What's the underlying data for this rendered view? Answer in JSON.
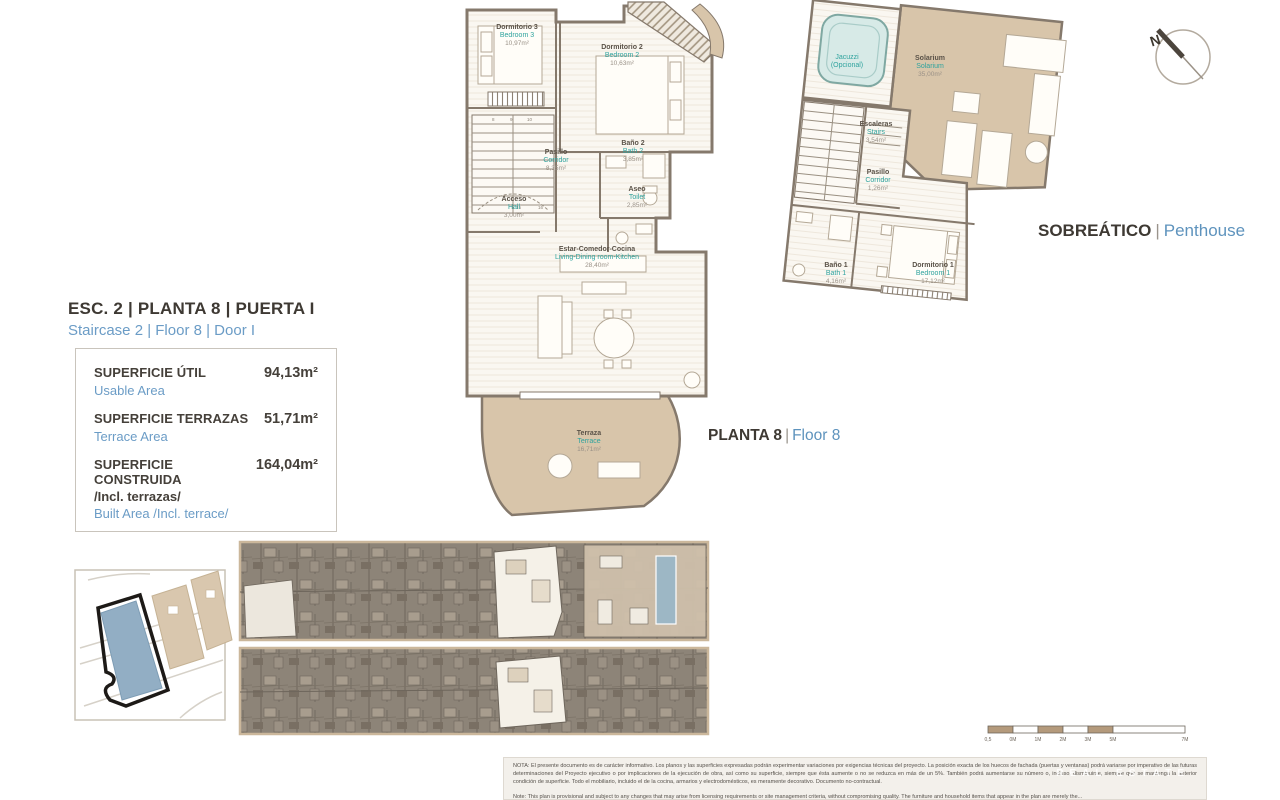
{
  "header": {
    "compass_label": "N",
    "penthouse_title": {
      "es": "SOBREÁTICO",
      "sep": "|",
      "en": "Penthouse"
    },
    "floor_title": {
      "es": "PLANTA 8",
      "sep": "|",
      "en": "Floor 8"
    }
  },
  "unit": {
    "title_es": "ESC. 2 | PLANTA 8 | PUERTA I",
    "title_en": "Staircase 2 | Floor 8 | Door I"
  },
  "areas": {
    "usable": {
      "label_es": "SUPERFICIE ÚTIL",
      "label_en": "Usable Area",
      "value": "94,13m²"
    },
    "terrace": {
      "label_es": "SUPERFICIE TERRAZAS",
      "label_en": "Terrace Area",
      "value": "51,71m²"
    },
    "built": {
      "label_es": "SUPERFICIE CONSTRUIDA",
      "label_es2": "/Incl. terrazas/",
      "label_en": "Built Area /Incl. terrace/",
      "value": "164,04m²"
    }
  },
  "floor8_rooms": [
    {
      "es": "Dormitorio 3",
      "en": "Bedroom 3",
      "area": "10,97m²"
    },
    {
      "es": "Dormitorio 2",
      "en": "Bedroom 2",
      "area": "10,63m²"
    },
    {
      "es": "Baño 2",
      "en": "Bath 2",
      "area": "3,85m²"
    },
    {
      "es": "Aseo",
      "en": "Toilet",
      "area": "2,85m²"
    },
    {
      "es": "Pasillo",
      "en": "Corridor",
      "area": "8,35m²"
    },
    {
      "es": "Acceso",
      "en": "Hall",
      "area": "3,00m²"
    },
    {
      "es": "Estar-Comedor-Cocina",
      "en": "Living-Dining room-Kitchen",
      "area": "28,40m²"
    },
    {
      "es": "Terraza",
      "en": "Terrace",
      "area": "16,71m²"
    }
  ],
  "penthouse_rooms": [
    {
      "es": "Jacuzzi",
      "en": "(Opcional)",
      "area": ""
    },
    {
      "es": "Solarium",
      "en": "Solarium",
      "area": "35,00m²"
    },
    {
      "es": "Escaleras",
      "en": "Stairs",
      "area": "3,54m²"
    },
    {
      "es": "Pasillo",
      "en": "Corridor",
      "area": "1,26m²"
    },
    {
      "es": "Baño 1",
      "en": "Bath 1",
      "area": "4,16m²"
    },
    {
      "es": "Dormitorio 1",
      "en": "Bedroom 1",
      "area": "17,12m²"
    }
  ],
  "stair_numbers": [
    "8",
    "9",
    "10",
    "15",
    "16"
  ],
  "scalebar": {
    "labels": [
      "0,5",
      "0M",
      "1M",
      "2M",
      "3M",
      "5M",
      "7M"
    ]
  },
  "disclaimer": {
    "es": "NOTA: El presente documento es de carácter informativo. Los planos y las superficies expresadas podrán experimentar variaciones por exigencias técnicas del proyecto. La posición exacta de los huecos de fachada (puertas y ventanas) podrá variarse por imperativo de las futuras determinaciones del Proyecto ejecutivo o por implicaciones de la ejecución de obra, así como su superficie, siempre que ésta aumente o no se reduzca en más de un 5%. También podrá aumentarse su número o, incluso, disminuirse, siempre que se mantenga la anterior condición de superficie. Todo el mobiliario, incluido el de la cocina, armarios y electrodomésticos, es meramente decorativo. Documento no-contractual.",
    "en": "Note: This plan is provisional and subject to any changes that may arise from licensing requirements or site management criteria, without compromising quality. The furniture and household items that appear in the plan are merely the..."
  },
  "watermark": "REAL ESTATE",
  "colors": {
    "teal_room_en": "#2fa39e",
    "blue_en": "#5e93bd",
    "terrace_tan": "#d8c5aa",
    "wall": "#85796c",
    "keyplan_base": "#8d8478",
    "pool_blue": "#9db7c5",
    "site_building_blue": "#92aec4"
  }
}
